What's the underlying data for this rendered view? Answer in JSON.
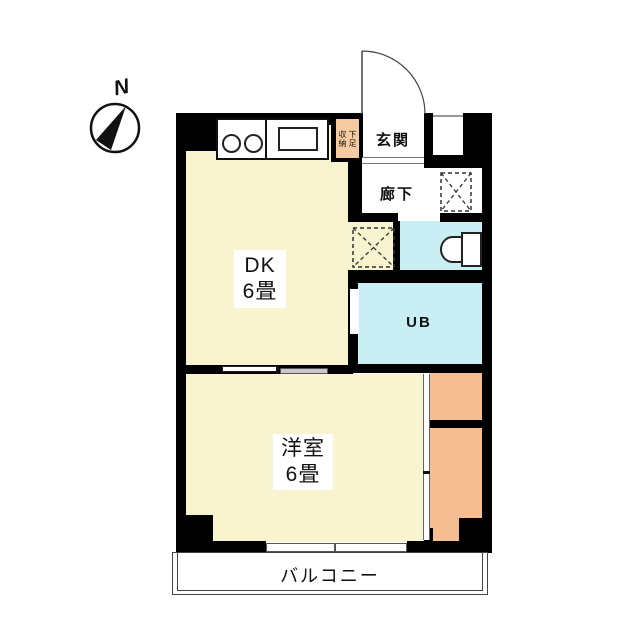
{
  "compass": {
    "north_label": "N"
  },
  "rooms": {
    "dk": {
      "name": "DK",
      "size": "6畳"
    },
    "western": {
      "name": "洋室",
      "size": "6畳"
    },
    "entrance": {
      "label": "玄関"
    },
    "hallway": {
      "label": "廊下"
    },
    "unit_bath": {
      "label": "UB"
    },
    "balcony": {
      "label": "バルコニー"
    },
    "shoe_storage": {
      "left_column": "収納",
      "right_column": "下足"
    }
  },
  "icons": {
    "compass": "compass-north-icon",
    "door_swing": "entrance-door-swing-icon",
    "stove": "stove-burners-icon",
    "sink": "kitchen-sink-icon",
    "toilet": "toilet-icon",
    "appliance_space": "appliance-space-x-icon"
  },
  "colors": {
    "room_cream": "#f8f4d0",
    "wet_area_cyan": "#c9eef3",
    "closet_orange": "#f4bd92",
    "shoe_storage_orange": "#f7cba1",
    "wall_black": "#000000"
  }
}
